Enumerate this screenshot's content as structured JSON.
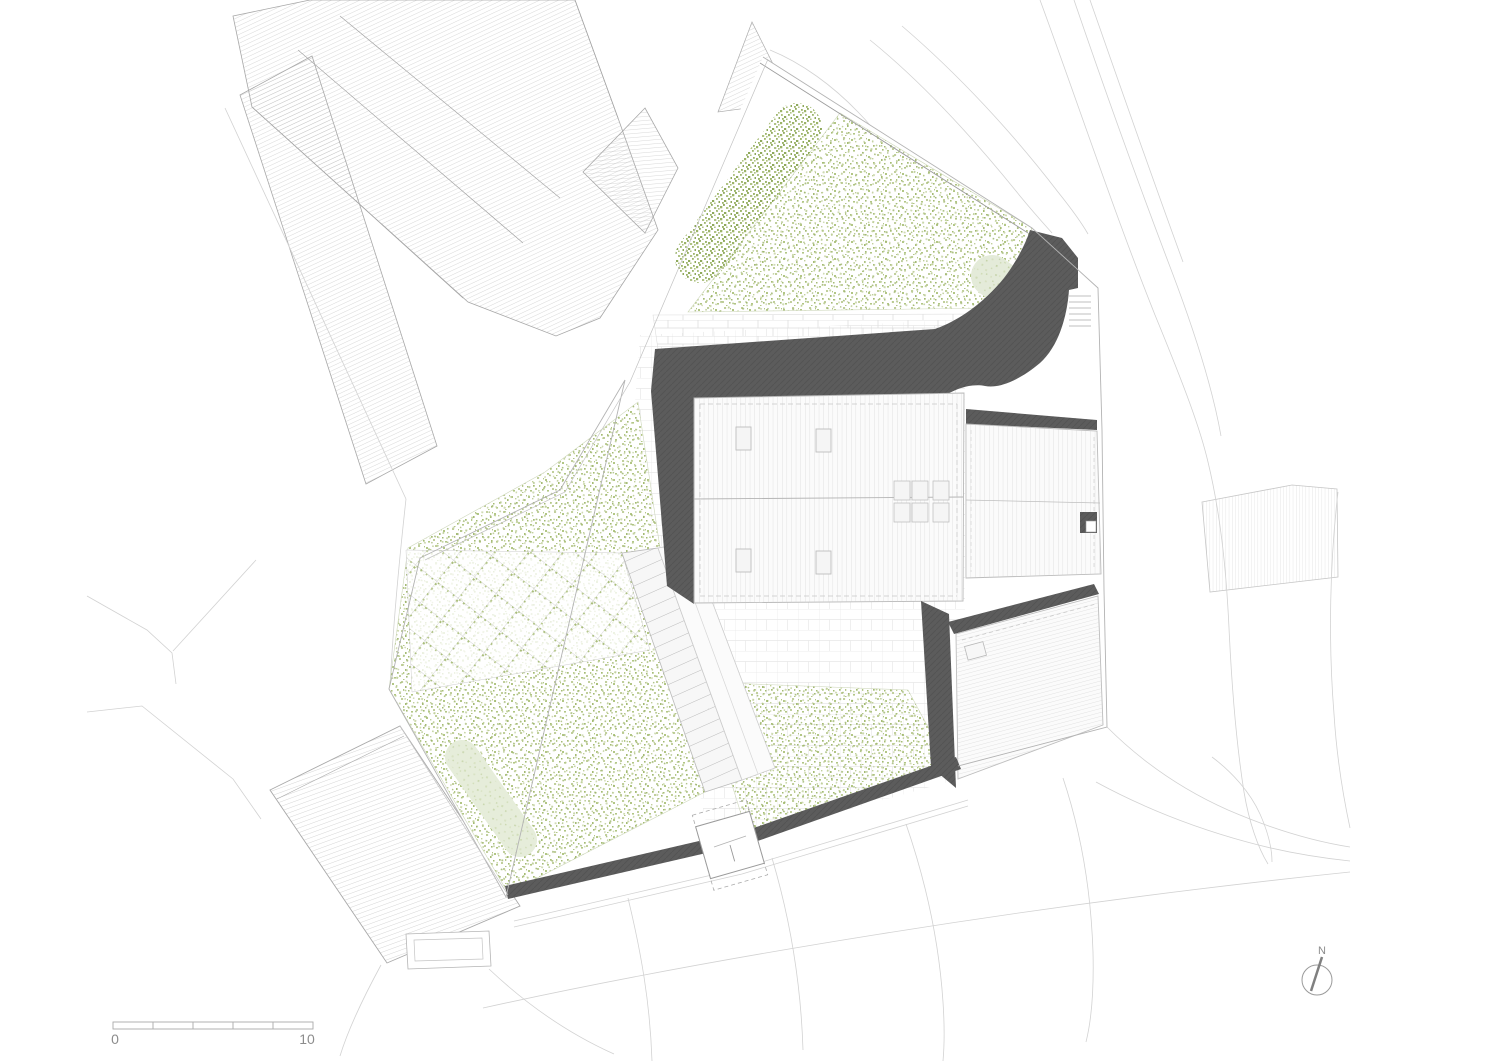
{
  "document": {
    "type": "architectural-site-plan",
    "view": "roof plan with landscape"
  },
  "scale_bar": {
    "start_label": "0",
    "end_label": "10"
  },
  "north_arrow": {
    "label": "N"
  },
  "palette": {
    "roof_shadow_dark": "#5c5c5c",
    "vegetation_green": "#aec37f",
    "hedge_green": "#9cb469",
    "pale_path_green": "#e4ebd9",
    "paving_line": "#e8e8e8",
    "hatch_line": "#b1b1b1",
    "contour_line": "#d2d2d2",
    "boundary_line": "#9b9b9b",
    "label_gray": "#8c8c8c"
  }
}
